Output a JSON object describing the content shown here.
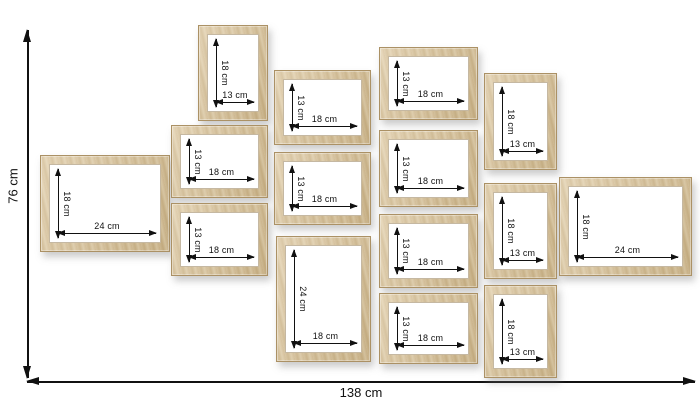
{
  "diagram": {
    "overall_height_label": "76 cm",
    "overall_width_label": "138 cm",
    "unit": "cm",
    "frame_count": 15
  },
  "colors": {
    "background": "#ffffff",
    "wood_base": "#d3bc92",
    "wood_dark": "#c3a97c",
    "wood_light": "#e3d2ac",
    "wood_edge": "#ab9165",
    "dimension_line": "#111111",
    "frame_opening": "#ffffff"
  },
  "frames": [
    {
      "id": "left-24x18",
      "width_label": "24 cm",
      "height_label": "18 cm",
      "x": 40,
      "y": 155,
      "w": 130,
      "h": 97
    },
    {
      "id": "col2-top-13x18",
      "width_label": "13 cm",
      "height_label": "18 cm",
      "x": 198,
      "y": 25,
      "w": 70,
      "h": 96
    },
    {
      "id": "col2-mid-18x13",
      "width_label": "18 cm",
      "height_label": "13 cm",
      "x": 171,
      "y": 125,
      "w": 97,
      "h": 73
    },
    {
      "id": "col2-bot-18x13",
      "width_label": "18 cm",
      "height_label": "13 cm",
      "x": 171,
      "y": 203,
      "w": 97,
      "h": 73
    },
    {
      "id": "col3-top-18x13",
      "width_label": "18 cm",
      "height_label": "13 cm",
      "x": 274,
      "y": 70,
      "w": 97,
      "h": 75
    },
    {
      "id": "col3-mid-18x13",
      "width_label": "18 cm",
      "height_label": "13 cm",
      "x": 274,
      "y": 152,
      "w": 97,
      "h": 73
    },
    {
      "id": "col3-bot-18x24",
      "width_label": "18 cm",
      "height_label": "24 cm",
      "x": 276,
      "y": 236,
      "w": 95,
      "h": 126
    },
    {
      "id": "col4-1-18x13",
      "width_label": "18 cm",
      "height_label": "13 cm",
      "x": 379,
      "y": 47,
      "w": 99,
      "h": 73
    },
    {
      "id": "col4-2-18x13",
      "width_label": "18 cm",
      "height_label": "13 cm",
      "x": 379,
      "y": 130,
      "w": 99,
      "h": 77
    },
    {
      "id": "col4-3-18x13",
      "width_label": "18 cm",
      "height_label": "13 cm",
      "x": 379,
      "y": 214,
      "w": 99,
      "h": 74
    },
    {
      "id": "col4-4-18x13",
      "width_label": "18 cm",
      "height_label": "13 cm",
      "x": 379,
      "y": 293,
      "w": 99,
      "h": 71
    },
    {
      "id": "col5-top-13x18",
      "width_label": "13 cm",
      "height_label": "18 cm",
      "x": 484,
      "y": 73,
      "w": 73,
      "h": 97
    },
    {
      "id": "col5-mid-13x18",
      "width_label": "13 cm",
      "height_label": "18 cm",
      "x": 484,
      "y": 183,
      "w": 73,
      "h": 96
    },
    {
      "id": "col5-bot-13x18",
      "width_label": "13 cm",
      "height_label": "18 cm",
      "x": 484,
      "y": 285,
      "w": 73,
      "h": 93
    },
    {
      "id": "right-24x18",
      "width_label": "24 cm",
      "height_label": "18 cm",
      "x": 559,
      "y": 177,
      "w": 133,
      "h": 99
    }
  ]
}
